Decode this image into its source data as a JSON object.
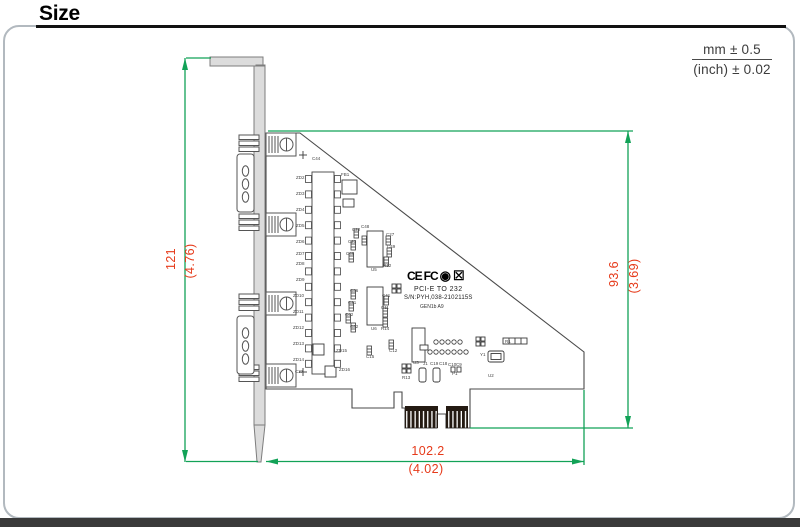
{
  "header": {
    "title": "Size"
  },
  "tolerance": {
    "line1": "mm ± 0.5",
    "line2": "(inch) ± 0.02"
  },
  "dimensions": {
    "bracket_height_mm": "121",
    "bracket_height_inch": "(4.76)",
    "board_height_mm": "93.6",
    "board_height_inch": "(3.69)",
    "board_width_mm": "102.2",
    "board_width_inch": "(4.02)"
  },
  "board_markings": {
    "logos": [
      {
        "id": "ce-logo",
        "glyph": "CE"
      },
      {
        "id": "fcc-logo",
        "glyph": "FC"
      },
      {
        "id": "rohs-logo",
        "glyph": "◉"
      },
      {
        "id": "weee-logo",
        "glyph": "☒"
      }
    ],
    "line1": "PCI-E TO 232",
    "line2": "S/N:PYH,038-2102115S",
    "line3": "GEN1b A9",
    "silkscreen": [
      {
        "t": "ZD2",
        "x": 296,
        "y": 176
      },
      {
        "t": "ZD3",
        "x": 296,
        "y": 192
      },
      {
        "t": "ZD4",
        "x": 296,
        "y": 208
      },
      {
        "t": "ZD5",
        "x": 296,
        "y": 224
      },
      {
        "t": "ZD6",
        "x": 296,
        "y": 240
      },
      {
        "t": "ZD7",
        "x": 296,
        "y": 252
      },
      {
        "t": "ZD8",
        "x": 296,
        "y": 262
      },
      {
        "t": "ZD9",
        "x": 296,
        "y": 278
      },
      {
        "t": "ZD10",
        "x": 293,
        "y": 294
      },
      {
        "t": "ZD11",
        "x": 293,
        "y": 310
      },
      {
        "t": "ZD12",
        "x": 293,
        "y": 326
      },
      {
        "t": "ZD13",
        "x": 293,
        "y": 342
      },
      {
        "t": "ZD14",
        "x": 293,
        "y": 358
      },
      {
        "t": "C37",
        "x": 295,
        "y": 370
      },
      {
        "t": "FB1",
        "x": 341,
        "y": 173
      },
      {
        "t": "ZD15",
        "x": 336,
        "y": 349
      },
      {
        "t": "ZD16",
        "x": 339,
        "y": 368
      },
      {
        "t": "U5",
        "x": 371,
        "y": 268
      },
      {
        "t": "U6",
        "x": 371,
        "y": 327
      },
      {
        "t": "C22",
        "x": 352,
        "y": 228
      },
      {
        "t": "C23",
        "x": 348,
        "y": 240
      },
      {
        "t": "C46",
        "x": 346,
        "y": 252
      },
      {
        "t": "C48",
        "x": 361,
        "y": 225
      },
      {
        "t": "C27",
        "x": 386,
        "y": 233
      },
      {
        "t": "C49",
        "x": 387,
        "y": 245
      },
      {
        "t": "R12",
        "x": 383,
        "y": 264
      },
      {
        "t": "C36",
        "x": 350,
        "y": 289
      },
      {
        "t": "C21",
        "x": 348,
        "y": 301
      },
      {
        "t": "C42",
        "x": 345,
        "y": 313
      },
      {
        "t": "C32",
        "x": 350,
        "y": 325
      },
      {
        "t": "C41",
        "x": 382,
        "y": 294
      },
      {
        "t": "C11",
        "x": 381,
        "y": 306
      },
      {
        "t": "R14",
        "x": 381,
        "y": 327
      },
      {
        "t": "C15",
        "x": 366,
        "y": 355
      },
      {
        "t": "C12",
        "x": 389,
        "y": 349
      },
      {
        "t": "U3",
        "x": 413,
        "y": 361
      },
      {
        "t": "J1",
        "x": 423,
        "y": 362
      },
      {
        "t": "C19",
        "x": 430,
        "y": 362
      },
      {
        "t": "C18",
        "x": 439,
        "y": 362
      },
      {
        "t": "C10",
        "x": 448,
        "y": 363
      },
      {
        "t": "C9",
        "x": 456,
        "y": 363
      },
      {
        "t": "R13",
        "x": 402,
        "y": 376
      },
      {
        "t": "P1",
        "x": 452,
        "y": 372
      },
      {
        "t": "Y1",
        "x": 480,
        "y": 353
      },
      {
        "t": "U2",
        "x": 488,
        "y": 374
      },
      {
        "t": "R1",
        "x": 505,
        "y": 340
      },
      {
        "t": "C44",
        "x": 312,
        "y": 157
      }
    ]
  },
  "colors": {
    "dimension_line": "#12a257",
    "dimension_text": "#e63a1a",
    "outline": "#4a4a4a",
    "frame": "#b2b9bf"
  }
}
